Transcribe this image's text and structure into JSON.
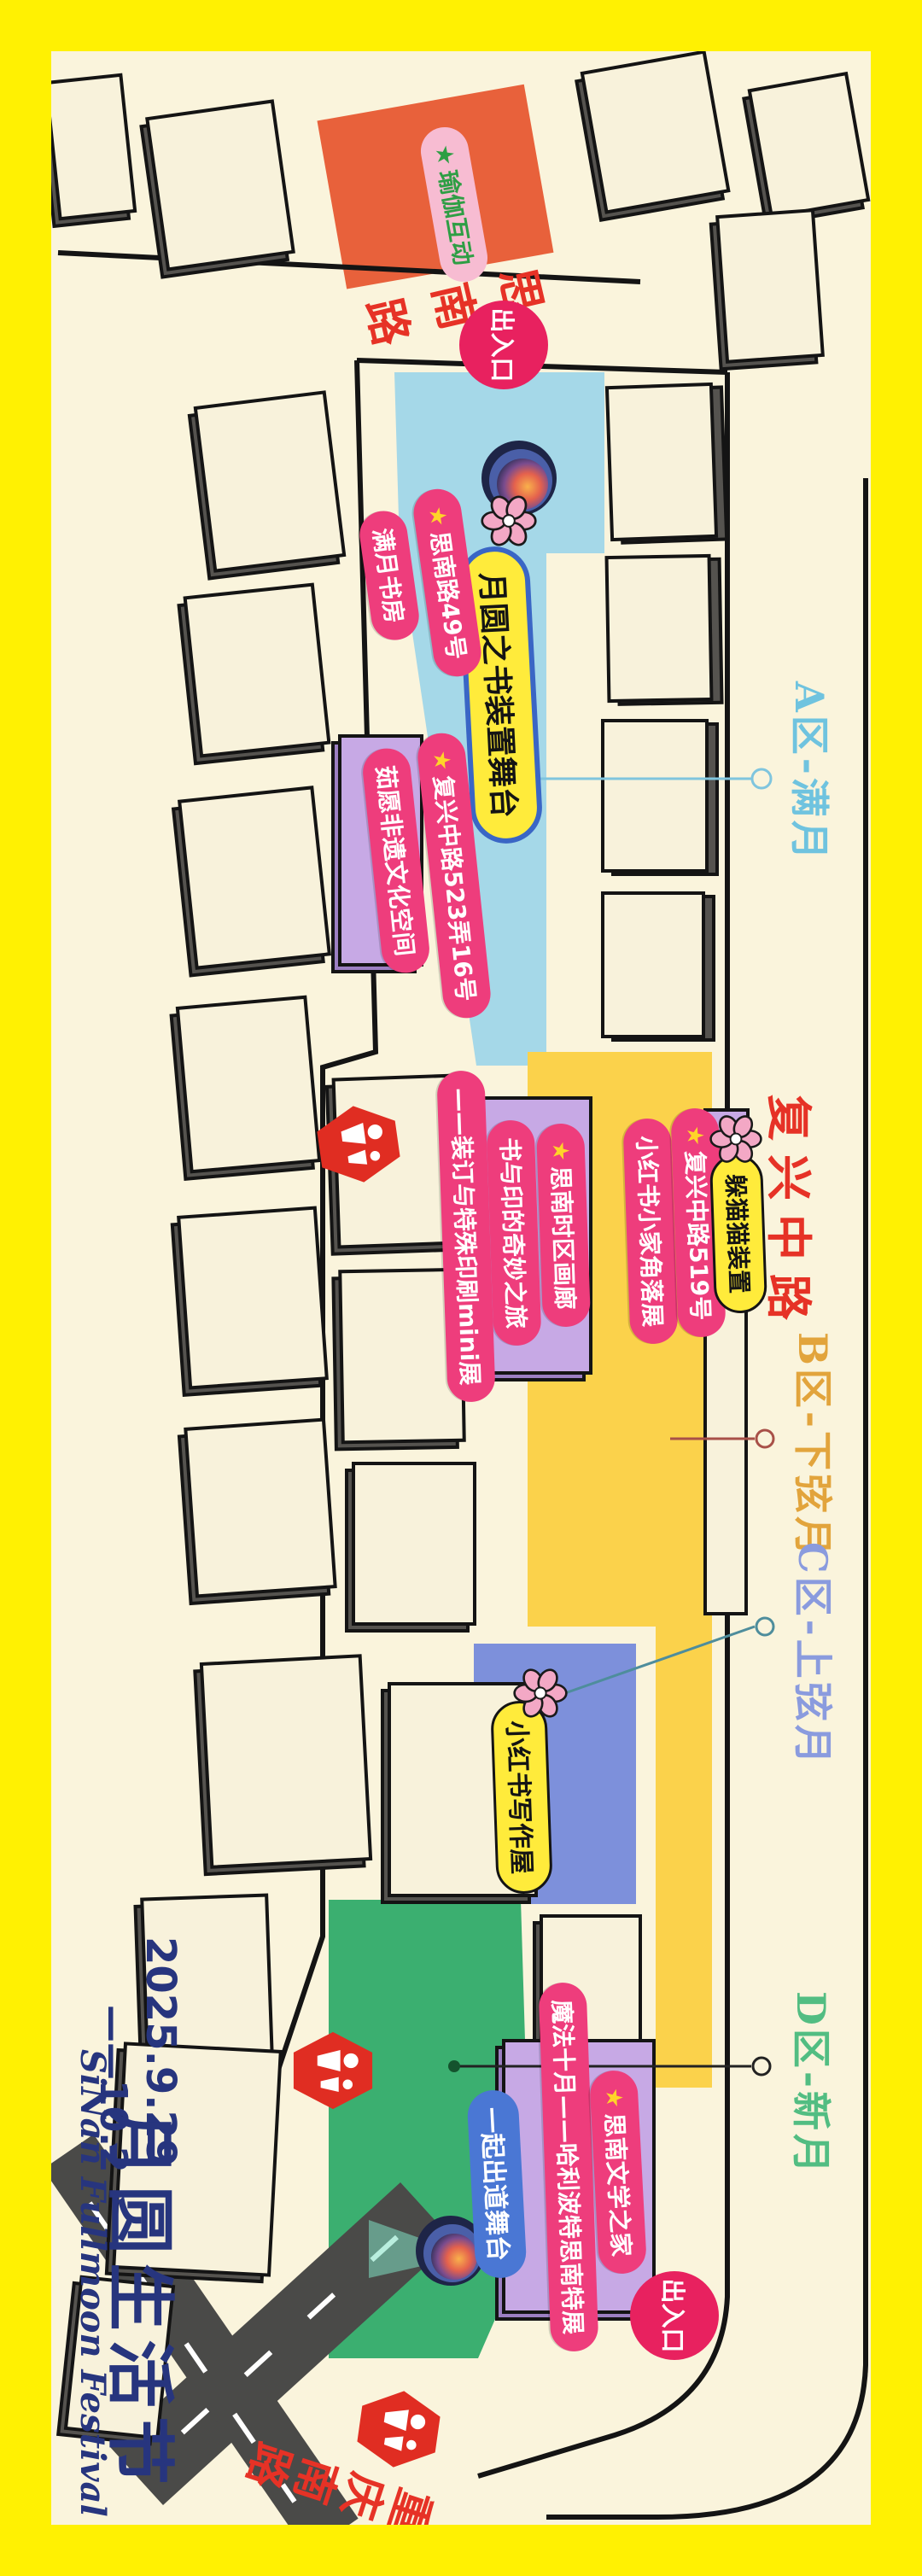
{
  "poster": {
    "frame_color": "#FFF102",
    "background_color": "#FAF4DC"
  },
  "title": {
    "date_line1": "2025.9.29",
    "date_line2": "——10.2",
    "name": "月圆生活节",
    "subtitle": "SiNan Fullmoon Festival"
  },
  "roads": {
    "sinan": "思南路",
    "fuxing": "复兴中路",
    "chongqing": "重庆南路"
  },
  "entrances": [
    {
      "label": "出入口"
    },
    {
      "label": "出入口"
    }
  ],
  "zones": [
    {
      "id": "A",
      "label": "A区-满月",
      "label_color": "#6FC3DF",
      "area_color": "#A5D8E8"
    },
    {
      "id": "B",
      "label": "B区-下弦月",
      "label_color": "#E2A43C",
      "area_color": "#FBD24B"
    },
    {
      "id": "C",
      "label": "C区-上弦月",
      "label_color": "#8A9BDE",
      "area_color": "#7D90DB"
    },
    {
      "id": "D",
      "label": "D区-新月",
      "label_color": "#52BD82",
      "area_color": "#3BAF70"
    }
  ],
  "spots": {
    "yoga": {
      "star": "★",
      "label": "瑜伽互动"
    },
    "manyue_addr": {
      "star": "★",
      "label": "思南路49号"
    },
    "manyue_name": {
      "label": "满月书房"
    },
    "stage_book": {
      "label": "月圆之书装置舞台"
    },
    "ruyuan_addr": {
      "star": "★",
      "label": "复兴中路523弄16号"
    },
    "ruyuan_name": {
      "label": "茹愿非遗文化空间"
    },
    "print_line1": {
      "label": "书与印的奇妙之旅"
    },
    "print_line2": {
      "label": "——装订与特殊印刷mini展"
    },
    "gallery": {
      "star": "★",
      "label": "思南时区画廊"
    },
    "xhs_corner": {
      "label": "小红书小家角落展"
    },
    "fuxing519": {
      "star": "★",
      "label": "复兴中路519号"
    },
    "hide_cat": {
      "label": "躲猫猫装置"
    },
    "xhs_writing": {
      "label": "小红书写作屋"
    },
    "debut_stage": {
      "label": "一起出道舞台"
    },
    "magic_october": {
      "label": "魔法十月——哈利波特思南特展"
    },
    "literature_house": {
      "star": "★",
      "label": "思南文学之家"
    }
  },
  "icons": {
    "restroom": "restroom-icon",
    "flower": "flower-icon",
    "moon": "moon-icon",
    "entrance_badge": "entrance-badge"
  }
}
